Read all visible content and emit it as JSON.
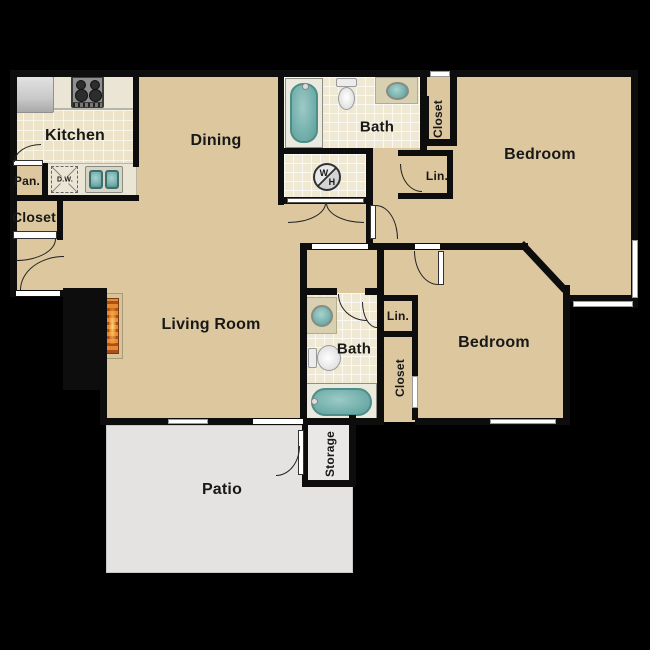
{
  "title": "Two Bedroom Apartment Floor Plan",
  "colors": {
    "floor_tan": "#dcc79e",
    "tile_cream": "#efe8d3",
    "patio_gray": "#e4e3e1",
    "wall_black": "#0d0d0d",
    "fixture_teal": "#76b2ae",
    "fireplace_orange": "#e08832"
  },
  "rooms": {
    "kitchen": {
      "label": "Kitchen"
    },
    "dining": {
      "label": "Dining"
    },
    "bath1": {
      "label": "Bath"
    },
    "closet_bed1": {
      "label": "Closet"
    },
    "bedroom1": {
      "label": "Bedroom"
    },
    "lin1": {
      "label": "Lin."
    },
    "pantry": {
      "label": "Pan."
    },
    "closet_left": {
      "label": "Closet"
    },
    "living": {
      "label": "Living Room"
    },
    "bath2": {
      "label": "Bath"
    },
    "lin2": {
      "label": "Lin."
    },
    "closet_bed2": {
      "label": "Closet"
    },
    "bedroom2": {
      "label": "Bedroom"
    },
    "storage": {
      "label": "Storage"
    },
    "patio": {
      "label": "Patio"
    }
  },
  "fixtures": {
    "dishwasher_label": "D.W.",
    "water_heater_top": "W",
    "water_heater_bottom": "H"
  }
}
